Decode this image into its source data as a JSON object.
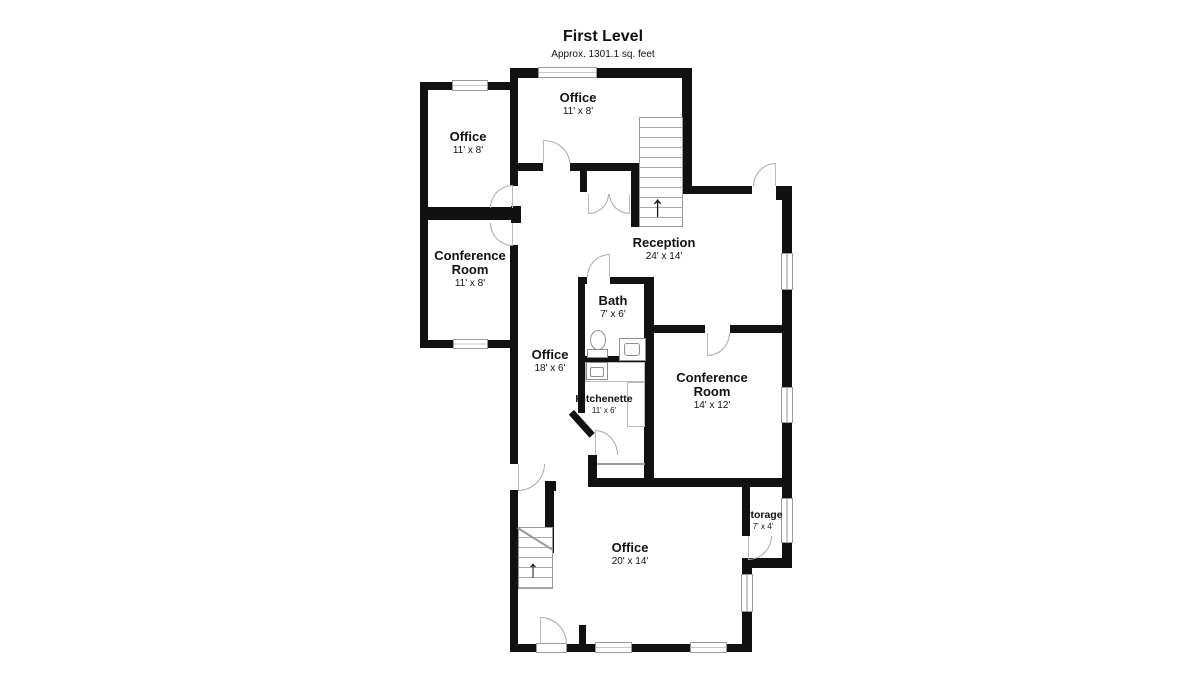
{
  "title": {
    "name": "First Level",
    "area": "Approx. 1301.1 sq. feet"
  },
  "colors": {
    "wall": "#111111",
    "background": "#ffffff",
    "line": "#9a9a9a",
    "text": "#111111"
  },
  "rooms": [
    {
      "id": "office-top-left",
      "name": "Office",
      "dims": "11' x 8'"
    },
    {
      "id": "office-top",
      "name": "Office",
      "dims": "11' x 8'"
    },
    {
      "id": "conference-left",
      "name": "Conference Room",
      "dims": "11' x 8'"
    },
    {
      "id": "reception",
      "name": "Reception",
      "dims": "24' x 14'"
    },
    {
      "id": "bath",
      "name": "Bath",
      "dims": "7' x 6'"
    },
    {
      "id": "office-middle",
      "name": "Office",
      "dims": "18' x 6'"
    },
    {
      "id": "conference-main",
      "name": "Conference Room",
      "dims": "14' x 12'"
    },
    {
      "id": "kitchenette",
      "name": "Kitchenette",
      "dims": "11' x 6'"
    },
    {
      "id": "storage",
      "name": "Storage",
      "dims": "7' x 4'"
    },
    {
      "id": "office-bottom",
      "name": "Office",
      "dims": "20' x 14'"
    }
  ],
  "icons": {
    "stairs_up_arrow": "↑"
  }
}
